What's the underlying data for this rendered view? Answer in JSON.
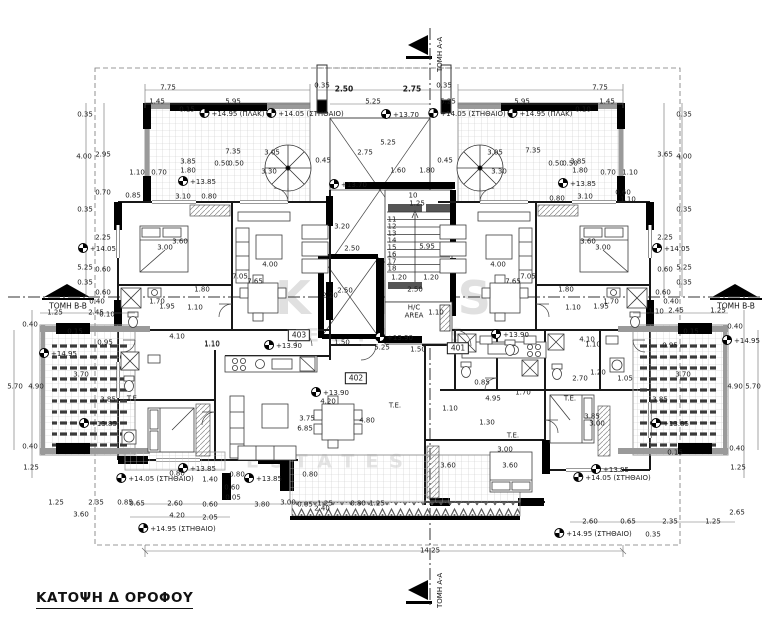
{
  "drawing": {
    "title": "ΚΑΤΟΨΗ Δ ΟΡΟΦΟΥ",
    "section_marker_top": "ΤΟΜΗ A-A",
    "section_marker_bottom": "ΤΟΜΗ A-A",
    "section_marker_left": "ΤΟΜΗ B-B",
    "section_marker_right": "ΤΟΜΗ B-B",
    "colors": {
      "walls": "#000000",
      "tile_grid": "#c9c9c9",
      "parapet": "#999999",
      "watermark": "#e0e0e0"
    },
    "labels": [
      {
        "t": "7.75",
        "x": 168,
        "y": 88
      },
      {
        "t": "1.45",
        "x": 157,
        "y": 102
      },
      {
        "t": "5.95",
        "x": 233,
        "y": 102
      },
      {
        "t": "0.35",
        "x": 322,
        "y": 86
      },
      {
        "t": "2.50",
        "x": 344,
        "y": 89,
        "b": 1
      },
      {
        "t": "2.75",
        "x": 412,
        "y": 89,
        "b": 1
      },
      {
        "t": "5.25",
        "x": 373,
        "y": 102
      },
      {
        "t": "5.25",
        "x": 448,
        "y": 102
      },
      {
        "t": "7.75",
        "x": 600,
        "y": 88
      },
      {
        "t": "5.95",
        "x": 522,
        "y": 102
      },
      {
        "t": "1.45",
        "x": 607,
        "y": 102
      },
      {
        "t": "0.35",
        "x": 444,
        "y": 86
      },
      {
        "t": "+14.95 (ΠΛΑΚ)",
        "x": 232,
        "y": 113,
        "k": "lvl"
      },
      {
        "t": "+14.05 (ΣΤΗΘΑΙΟ)",
        "x": 305,
        "y": 113,
        "k": "lvl"
      },
      {
        "t": "+14.05 (ΣΤΗΘΑΙΟ)",
        "x": 467,
        "y": 113,
        "k": "lvl"
      },
      {
        "t": "+14.95 (ΠΛΑΚ)",
        "x": 540,
        "y": 113,
        "k": "lvl"
      },
      {
        "t": "0.15",
        "x": 187,
        "y": 110
      },
      {
        "t": "0.10",
        "x": 583,
        "y": 110
      },
      {
        "t": "+13.70",
        "x": 400,
        "y": 114,
        "k": "lvl"
      },
      {
        "t": "+13.70",
        "x": 348,
        "y": 184,
        "k": "lvl"
      },
      {
        "t": "7.35",
        "x": 233,
        "y": 152
      },
      {
        "t": "3.05",
        "x": 272,
        "y": 153
      },
      {
        "t": "3.85",
        "x": 188,
        "y": 162
      },
      {
        "t": "0.50",
        "x": 222,
        "y": 164
      },
      {
        "t": "0.50",
        "x": 236,
        "y": 164
      },
      {
        "t": "1.80",
        "x": 188,
        "y": 171
      },
      {
        "t": "3.30",
        "x": 269,
        "y": 172
      },
      {
        "t": "1.10",
        "x": 137,
        "y": 173
      },
      {
        "t": "0.70",
        "x": 159,
        "y": 173
      },
      {
        "t": "+13.85",
        "x": 197,
        "y": 181,
        "k": "lvl"
      },
      {
        "t": "3.10",
        "x": 183,
        "y": 197
      },
      {
        "t": "0.80",
        "x": 209,
        "y": 197
      },
      {
        "t": "0.85",
        "x": 133,
        "y": 196
      },
      {
        "t": "0.45",
        "x": 323,
        "y": 161
      },
      {
        "t": "7.35",
        "x": 533,
        "y": 151
      },
      {
        "t": "3.05",
        "x": 495,
        "y": 153
      },
      {
        "t": "3.85",
        "x": 578,
        "y": 162
      },
      {
        "t": "0.50",
        "x": 556,
        "y": 164
      },
      {
        "t": "0.50",
        "x": 570,
        "y": 164
      },
      {
        "t": "1.80",
        "x": 580,
        "y": 171
      },
      {
        "t": "3.30",
        "x": 499,
        "y": 172
      },
      {
        "t": "0.70",
        "x": 608,
        "y": 173
      },
      {
        "t": "1.10",
        "x": 630,
        "y": 173
      },
      {
        "t": "+13.85",
        "x": 577,
        "y": 183,
        "k": "lvl"
      },
      {
        "t": "3.10",
        "x": 585,
        "y": 197
      },
      {
        "t": "0.80",
        "x": 557,
        "y": 199
      },
      {
        "t": "0.60",
        "x": 623,
        "y": 193
      },
      {
        "t": "1.10",
        "x": 628,
        "y": 200
      },
      {
        "t": "0.45",
        "x": 445,
        "y": 161
      },
      {
        "t": "2.75",
        "x": 365,
        "y": 153
      },
      {
        "t": "5.25",
        "x": 388,
        "y": 143
      },
      {
        "t": "1.60",
        "x": 398,
        "y": 171
      },
      {
        "t": "1.80",
        "x": 427,
        "y": 171
      },
      {
        "t": "3.20",
        "x": 342,
        "y": 227
      },
      {
        "t": "2.50",
        "x": 352,
        "y": 249
      },
      {
        "t": "2.50",
        "x": 345,
        "y": 291
      },
      {
        "t": "2.20",
        "x": 330,
        "y": 296
      },
      {
        "t": "10",
        "x": 413,
        "y": 196
      },
      {
        "t": "1.25",
        "x": 417,
        "y": 204
      },
      {
        "t": "11",
        "x": 392,
        "y": 220
      },
      {
        "t": "12",
        "x": 392,
        "y": 227
      },
      {
        "t": "13",
        "x": 392,
        "y": 234
      },
      {
        "t": "14",
        "x": 392,
        "y": 241
      },
      {
        "t": "15",
        "x": 392,
        "y": 248
      },
      {
        "t": "16",
        "x": 392,
        "y": 255
      },
      {
        "t": "17",
        "x": 392,
        "y": 262
      },
      {
        "t": "18",
        "x": 392,
        "y": 269
      },
      {
        "t": "5.95",
        "x": 427,
        "y": 247
      },
      {
        "t": "1.20",
        "x": 399,
        "y": 278
      },
      {
        "t": "1.20",
        "x": 431,
        "y": 278
      },
      {
        "t": "2.50",
        "x": 415,
        "y": 290
      },
      {
        "t": "H/C",
        "x": 414,
        "y": 308,
        "k": "room"
      },
      {
        "t": "AREA",
        "x": 414,
        "y": 316,
        "k": "room"
      },
      {
        "t": "1.10",
        "x": 436,
        "y": 313
      },
      {
        "t": "+13.90",
        "x": 394,
        "y": 337,
        "k": "lvl"
      },
      {
        "t": "1.50",
        "x": 342,
        "y": 343
      },
      {
        "t": "5.25",
        "x": 382,
        "y": 348
      },
      {
        "t": "1.50",
        "x": 418,
        "y": 350
      },
      {
        "t": "401",
        "x": 458,
        "y": 348,
        "k": "box"
      },
      {
        "t": "402",
        "x": 356,
        "y": 378,
        "k": "box"
      },
      {
        "t": "403",
        "x": 299,
        "y": 335,
        "k": "box"
      },
      {
        "t": "0.35",
        "x": 85,
        "y": 115
      },
      {
        "t": "4.00",
        "x": 84,
        "y": 157
      },
      {
        "t": "2.95",
        "x": 103,
        "y": 155
      },
      {
        "t": "0.35",
        "x": 85,
        "y": 210
      },
      {
        "t": "5.25",
        "x": 85,
        "y": 268
      },
      {
        "t": "2.25",
        "x": 103,
        "y": 238
      },
      {
        "t": "+14.05",
        "x": 97,
        "y": 248,
        "k": "lvl"
      },
      {
        "t": "0.60",
        "x": 103,
        "y": 270
      },
      {
        "t": "0.35",
        "x": 85,
        "y": 283
      },
      {
        "t": "0.60",
        "x": 103,
        "y": 293
      },
      {
        "t": "0.40",
        "x": 97,
        "y": 302
      },
      {
        "t": "0.70",
        "x": 103,
        "y": 193
      },
      {
        "t": "1.25",
        "x": 55,
        "y": 313
      },
      {
        "t": "2.45",
        "x": 96,
        "y": 313
      },
      {
        "t": "0.10",
        "x": 107,
        "y": 315
      },
      {
        "t": "0.40",
        "x": 30,
        "y": 325
      },
      {
        "t": "0.15",
        "x": 75,
        "y": 332
      },
      {
        "t": "+14.95",
        "x": 58,
        "y": 353,
        "k": "lvl"
      },
      {
        "t": "0.95",
        "x": 105,
        "y": 343
      },
      {
        "t": "3.70",
        "x": 81,
        "y": 375
      },
      {
        "t": "4.90",
        "x": 36,
        "y": 387
      },
      {
        "t": "5.70",
        "x": 15,
        "y": 387
      },
      {
        "t": "3.85",
        "x": 108,
        "y": 400
      },
      {
        "t": "+13.85",
        "x": 98,
        "y": 423,
        "k": "lvl"
      },
      {
        "t": "0.40",
        "x": 30,
        "y": 447
      },
      {
        "t": "1.25",
        "x": 31,
        "y": 468
      },
      {
        "t": "1.25",
        "x": 56,
        "y": 503
      },
      {
        "t": "2.35",
        "x": 96,
        "y": 503
      },
      {
        "t": "3.60",
        "x": 81,
        "y": 515
      },
      {
        "t": "0.85",
        "x": 125,
        "y": 503
      },
      {
        "t": "0.35",
        "x": 684,
        "y": 115
      },
      {
        "t": "4.00",
        "x": 684,
        "y": 157
      },
      {
        "t": "3.65",
        "x": 665,
        "y": 155
      },
      {
        "t": "0.35",
        "x": 684,
        "y": 210
      },
      {
        "t": "5.25",
        "x": 684,
        "y": 268
      },
      {
        "t": "2.25",
        "x": 665,
        "y": 238
      },
      {
        "t": "+14.05",
        "x": 671,
        "y": 248,
        "k": "lvl"
      },
      {
        "t": "0.60",
        "x": 665,
        "y": 270
      },
      {
        "t": "0.35",
        "x": 684,
        "y": 283
      },
      {
        "t": "0.60",
        "x": 663,
        "y": 293
      },
      {
        "t": "0.40",
        "x": 671,
        "y": 302
      },
      {
        "t": "1.10",
        "x": 656,
        "y": 312
      },
      {
        "t": "2.45",
        "x": 676,
        "y": 311
      },
      {
        "t": "1.25",
        "x": 718,
        "y": 311
      },
      {
        "t": "0.40",
        "x": 735,
        "y": 327
      },
      {
        "t": "+14.95",
        "x": 741,
        "y": 340,
        "k": "lvl"
      },
      {
        "t": "0.95",
        "x": 670,
        "y": 346
      },
      {
        "t": "3.70",
        "x": 683,
        "y": 375
      },
      {
        "t": "4.90",
        "x": 735,
        "y": 387
      },
      {
        "t": "5.70",
        "x": 753,
        "y": 387
      },
      {
        "t": "0.15",
        "x": 691,
        "y": 332
      },
      {
        "t": "3.85",
        "x": 660,
        "y": 400
      },
      {
        "t": "+13.85",
        "x": 670,
        "y": 423,
        "k": "lvl"
      },
      {
        "t": "0.40",
        "x": 737,
        "y": 449
      },
      {
        "t": "1.25",
        "x": 738,
        "y": 468
      },
      {
        "t": "2.65",
        "x": 737,
        "y": 513
      },
      {
        "t": "2.60",
        "x": 590,
        "y": 522
      },
      {
        "t": "0.65",
        "x": 628,
        "y": 522
      },
      {
        "t": "2.35",
        "x": 670,
        "y": 522
      },
      {
        "t": "1.25",
        "x": 713,
        "y": 522
      },
      {
        "t": "0.35",
        "x": 653,
        "y": 535
      },
      {
        "t": "+13.85",
        "x": 610,
        "y": 469,
        "k": "lvl"
      },
      {
        "t": "+14.05 (ΣΤΗΘΑΙΟ)",
        "x": 612,
        "y": 477,
        "k": "lvl"
      },
      {
        "t": "+14.95 (ΣΤΗΘΑΙΟ)",
        "x": 593,
        "y": 533,
        "k": "lvl"
      },
      {
        "t": "0.15",
        "x": 675,
        "y": 453
      },
      {
        "t": "+13.85",
        "x": 197,
        "y": 468,
        "k": "lvl"
      },
      {
        "t": "0.80",
        "x": 177,
        "y": 474
      },
      {
        "t": "+14.05 (ΣΤΗΘΑΙΟ)",
        "x": 155,
        "y": 478,
        "k": "lvl"
      },
      {
        "t": "1.40",
        "x": 210,
        "y": 480
      },
      {
        "t": "0.80",
        "x": 237,
        "y": 475
      },
      {
        "t": "+13.85",
        "x": 263,
        "y": 478,
        "k": "lvl"
      },
      {
        "t": "0.80",
        "x": 310,
        "y": 475
      },
      {
        "t": "0.60",
        "x": 232,
        "y": 488
      },
      {
        "t": "0.05",
        "x": 233,
        "y": 498
      },
      {
        "t": "0.65",
        "x": 137,
        "y": 504
      },
      {
        "t": "2.60",
        "x": 175,
        "y": 504
      },
      {
        "t": "0.60",
        "x": 210,
        "y": 505
      },
      {
        "t": "3.80",
        "x": 262,
        "y": 505
      },
      {
        "t": "3.00",
        "x": 288,
        "y": 503
      },
      {
        "t": "0.05",
        "x": 305,
        "y": 505
      },
      {
        "t": "1.25",
        "x": 325,
        "y": 504
      },
      {
        "t": "0.80",
        "x": 358,
        "y": 504
      },
      {
        "t": "1.25",
        "x": 377,
        "y": 504
      },
      {
        "t": "2.40",
        "x": 322,
        "y": 509
      },
      {
        "t": "4.20",
        "x": 177,
        "y": 516
      },
      {
        "t": "2.05",
        "x": 210,
        "y": 518
      },
      {
        "t": "+14.95 (ΣΤΗΘΑΙΟ)",
        "x": 177,
        "y": 528,
        "k": "lvl"
      },
      {
        "t": "14.25",
        "x": 430,
        "y": 551
      },
      {
        "t": "3.60",
        "x": 180,
        "y": 242
      },
      {
        "t": "3.00",
        "x": 165,
        "y": 248
      },
      {
        "t": "4.00",
        "x": 270,
        "y": 265
      },
      {
        "t": "7.05",
        "x": 240,
        "y": 277
      },
      {
        "t": "7.65",
        "x": 255,
        "y": 282
      },
      {
        "t": "1.80",
        "x": 202,
        "y": 290
      },
      {
        "t": "1.70",
        "x": 157,
        "y": 302
      },
      {
        "t": "1.95",
        "x": 167,
        "y": 307
      },
      {
        "t": "1.10",
        "x": 195,
        "y": 308
      },
      {
        "t": "4.10",
        "x": 177,
        "y": 337
      },
      {
        "t": "1.10",
        "x": 212,
        "y": 344
      },
      {
        "t": "+13.90",
        "x": 283,
        "y": 345,
        "k": "lvl"
      },
      {
        "t": "+13.90",
        "x": 330,
        "y": 392,
        "k": "lvl"
      },
      {
        "t": "3.60",
        "x": 588,
        "y": 242
      },
      {
        "t": "3.00",
        "x": 603,
        "y": 248
      },
      {
        "t": "4.00",
        "x": 498,
        "y": 265
      },
      {
        "t": "7.05",
        "x": 528,
        "y": 277
      },
      {
        "t": "7.65",
        "x": 513,
        "y": 282
      },
      {
        "t": "1.80",
        "x": 566,
        "y": 290
      },
      {
        "t": "1.70",
        "x": 611,
        "y": 302
      },
      {
        "t": "1.95",
        "x": 601,
        "y": 307
      },
      {
        "t": "1.10",
        "x": 573,
        "y": 308
      },
      {
        "t": "1.10",
        "x": 212,
        "y": 345
      },
      {
        "t": "4.20",
        "x": 328,
        "y": 402
      },
      {
        "t": "3.75",
        "x": 307,
        "y": 419
      },
      {
        "t": "4.80",
        "x": 367,
        "y": 421
      },
      {
        "t": "6.85",
        "x": 305,
        "y": 429
      },
      {
        "t": "T.E.",
        "x": 395,
        "y": 406,
        "k": "room"
      },
      {
        "t": "T.E.",
        "x": 133,
        "y": 399,
        "k": "room"
      },
      {
        "t": "4.10",
        "x": 587,
        "y": 340
      },
      {
        "t": "1.10",
        "x": 593,
        "y": 345
      },
      {
        "t": "+13.90",
        "x": 510,
        "y": 334,
        "k": "lvl"
      },
      {
        "t": "0.85",
        "x": 482,
        "y": 383
      },
      {
        "t": "1.70",
        "x": 523,
        "y": 393
      },
      {
        "t": "2.70",
        "x": 580,
        "y": 379
      },
      {
        "t": "1.20",
        "x": 598,
        "y": 373
      },
      {
        "t": "1.05",
        "x": 625,
        "y": 379
      },
      {
        "t": "1.10",
        "x": 450,
        "y": 409
      },
      {
        "t": "4.95",
        "x": 493,
        "y": 399
      },
      {
        "t": "1.30",
        "x": 487,
        "y": 423
      },
      {
        "t": "T.E.",
        "x": 513,
        "y": 436,
        "k": "room"
      },
      {
        "t": "T.E.",
        "x": 570,
        "y": 399,
        "k": "room"
      },
      {
        "t": "3.85",
        "x": 592,
        "y": 417
      },
      {
        "t": "3.00",
        "x": 597,
        "y": 424
      },
      {
        "t": "3.00",
        "x": 505,
        "y": 450
      },
      {
        "t": "3.60",
        "x": 510,
        "y": 466
      },
      {
        "t": "3.60",
        "x": 448,
        "y": 466
      },
      {
        "t": "KADIS",
        "x": 390,
        "y": 298,
        "k": "wm1"
      },
      {
        "t": "ESTATES",
        "x": 390,
        "y": 336,
        "k": "wm2"
      },
      {
        "t": "ESTATES",
        "x": 330,
        "y": 462,
        "k": "wm2"
      }
    ]
  }
}
